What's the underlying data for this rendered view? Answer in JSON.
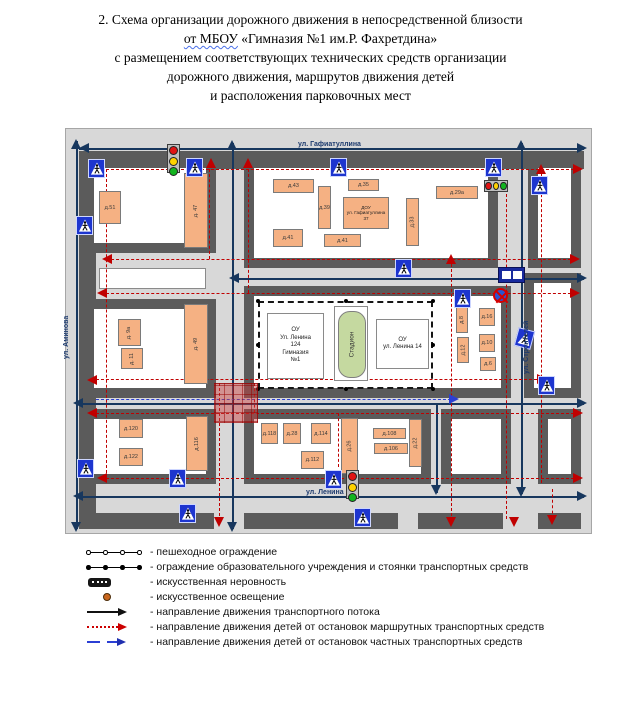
{
  "title": {
    "line1": "2. Схема организации дорожного движения в непосредственной близости",
    "line2_wavy": "от МБОУ",
    "line2_rest": " «Гимназия №1 им.Р. Фахретдина»",
    "line3": "с размещением соответствующих технических средств организации",
    "line4": "дорожного движения, маршрутов движения детей",
    "line5": "и расположения парковочных мест"
  },
  "map": {
    "street_labels": [
      {
        "text": "ул. Гафиатуллина",
        "x": 232,
        "y": 12,
        "rot": 0
      },
      {
        "text": "ул. Аминова",
        "x": -3,
        "y": 230,
        "rot": 1
      },
      {
        "text": "ул. Строителей",
        "x": 457,
        "y": 245,
        "rot": 1
      },
      {
        "text": "ул. Ленина",
        "x": 240,
        "y": 360,
        "rot": 0
      }
    ],
    "bands": [
      [
        13,
        22,
        505,
        18
      ],
      [
        13,
        22,
        17,
        378
      ],
      [
        20,
        384,
        128,
        16
      ],
      [
        178,
        384,
        154,
        16
      ],
      [
        352,
        384,
        85,
        16
      ],
      [
        472,
        384,
        43,
        16
      ]
    ],
    "blocks": [
      [
        18,
        29,
        132,
        95
      ],
      [
        178,
        29,
        254,
        110
      ],
      [
        462,
        29,
        53,
        110
      ],
      [
        18,
        170,
        132,
        99
      ],
      [
        178,
        157,
        267,
        112
      ],
      [
        458,
        144,
        57,
        125
      ],
      [
        18,
        280,
        132,
        75
      ],
      [
        178,
        280,
        187,
        75
      ],
      [
        375,
        280,
        70,
        75
      ],
      [
        472,
        280,
        43,
        75
      ]
    ],
    "strip": [
      33,
      139,
      107,
      21
    ],
    "navy_lines": [
      [
        13,
        19,
        518,
        19
      ],
      [
        10,
        12,
        10,
        400
      ],
      [
        166,
        14,
        166,
        400
      ],
      [
        455,
        14,
        455,
        365
      ],
      [
        370,
        276,
        370,
        364
      ],
      [
        166,
        149,
        518,
        149
      ],
      [
        10,
        274,
        518,
        274
      ],
      [
        10,
        367,
        518,
        367
      ]
    ],
    "red_lines": [
      [
        30,
        40,
        513,
        40
      ],
      [
        40,
        130,
        510,
        130
      ],
      [
        35,
        164,
        510,
        164
      ],
      [
        25,
        250,
        476,
        250
      ],
      [
        25,
        284,
        513,
        284
      ],
      [
        35,
        349,
        513,
        349
      ],
      [
        40,
        40,
        40,
        349
      ],
      [
        143,
        40,
        143,
        130
      ],
      [
        182,
        40,
        182,
        164
      ],
      [
        153,
        254,
        153,
        392
      ],
      [
        188,
        254,
        188,
        284
      ],
      [
        385,
        130,
        385,
        392
      ],
      [
        440,
        65,
        440,
        390
      ],
      [
        475,
        40,
        475,
        354
      ],
      [
        486,
        360,
        486,
        390
      ],
      [
        272,
        284,
        272,
        338
      ]
    ],
    "blue_lines": [
      [
        30,
        270,
        390,
        270
      ]
    ],
    "arrows": [
      [
        13,
        19,
        "left",
        "n"
      ],
      [
        521,
        19,
        "right",
        "n"
      ],
      [
        10,
        10,
        "up",
        "n"
      ],
      [
        10,
        403,
        "down",
        "n"
      ],
      [
        166,
        11,
        "up",
        "n"
      ],
      [
        166,
        403,
        "down",
        "n"
      ],
      [
        455,
        11,
        "up",
        "n"
      ],
      [
        455,
        368,
        "down",
        "n"
      ],
      [
        370,
        366,
        "down",
        "n"
      ],
      [
        163,
        149,
        "left",
        "n"
      ],
      [
        521,
        149,
        "right",
        "n"
      ],
      [
        7,
        274,
        "left",
        "n"
      ],
      [
        521,
        274,
        "right",
        "n"
      ],
      [
        7,
        367,
        "left",
        "n"
      ],
      [
        521,
        367,
        "right",
        "n"
      ],
      [
        517,
        40,
        "right",
        "r"
      ],
      [
        36,
        130,
        "left",
        "r"
      ],
      [
        514,
        130,
        "right",
        "r"
      ],
      [
        31,
        164,
        "left",
        "r"
      ],
      [
        514,
        164,
        "right",
        "r"
      ],
      [
        21,
        251,
        "left",
        "r"
      ],
      [
        481,
        250,
        "right",
        "r"
      ],
      [
        21,
        284,
        "left",
        "r"
      ],
      [
        517,
        284,
        "right",
        "r"
      ],
      [
        31,
        349,
        "left",
        "r"
      ],
      [
        517,
        349,
        "right",
        "r"
      ],
      [
        145,
        29,
        "up",
        "r"
      ],
      [
        182,
        29,
        "up",
        "r"
      ],
      [
        385,
        125,
        "up",
        "r"
      ],
      [
        475,
        35,
        "up",
        "r"
      ],
      [
        153,
        398,
        "down",
        "r"
      ],
      [
        385,
        398,
        "down",
        "r"
      ],
      [
        448,
        398,
        "down",
        "r"
      ],
      [
        486,
        396,
        "down",
        "r"
      ],
      [
        393,
        270,
        "right",
        "b"
      ]
    ],
    "red_zone": [
      148,
      254,
      42,
      38
    ],
    "school": {
      "fence": [
        192,
        172,
        175,
        88
      ],
      "fence_dots": [
        [
          192,
          172
        ],
        [
          367,
          172
        ],
        [
          192,
          260
        ],
        [
          367,
          260
        ],
        [
          280,
          172
        ],
        [
          280,
          260
        ],
        [
          192,
          216
        ],
        [
          367,
          216
        ]
      ],
      "gym": {
        "x": 201,
        "y": 184,
        "w": 57,
        "h": 66,
        "lines": [
          "ОУ",
          "Ул. Ленина",
          "124",
          "Гимназия",
          "№1"
        ]
      },
      "stadium": {
        "x": 268,
        "y": 177,
        "w": 34,
        "h": 75,
        "label": "Стадион"
      },
      "ou2": {
        "x": 310,
        "y": 190,
        "w": 53,
        "h": 50,
        "lines": [
          "ОУ",
          "ул. Ленина 14"
        ]
      }
    },
    "dou": {
      "x": 277,
      "y": 68,
      "w": 46,
      "h": 32,
      "lines": [
        "ДОУ",
        "ул. Гафиатуллина",
        "37"
      ]
    },
    "buildings": [
      [
        "д.51",
        33,
        62,
        22,
        33,
        0
      ],
      [
        "д. 47",
        118,
        44,
        24,
        75,
        1
      ],
      [
        "д.43",
        207,
        50,
        41,
        14,
        0
      ],
      [
        "д.35",
        282,
        50,
        31,
        12,
        0
      ],
      [
        "д.39",
        252,
        57,
        13,
        43,
        0
      ],
      [
        "д.33",
        340,
        69,
        13,
        48,
        1
      ],
      [
        "д.29а",
        370,
        57,
        42,
        13,
        0
      ],
      [
        "д.41",
        207,
        100,
        30,
        18,
        0
      ],
      [
        "д.41",
        258,
        105,
        37,
        13,
        0
      ],
      [
        "д. 9а",
        52,
        190,
        23,
        27,
        1
      ],
      [
        "д. 11",
        55,
        219,
        22,
        21,
        1
      ],
      [
        "д. 49",
        118,
        175,
        24,
        80,
        1
      ],
      [
        "д.8",
        390,
        177,
        12,
        27,
        1
      ],
      [
        "д.16",
        413,
        179,
        16,
        18,
        0
      ],
      [
        "д.10",
        413,
        205,
        16,
        18,
        0
      ],
      [
        "д.12",
        391,
        208,
        12,
        26,
        1
      ],
      [
        "д.6",
        414,
        228,
        16,
        14,
        0
      ],
      [
        "д.120",
        53,
        290,
        24,
        19,
        0
      ],
      [
        "д.122",
        53,
        319,
        24,
        18,
        0
      ],
      [
        "д.116",
        120,
        287,
        22,
        55,
        1
      ],
      [
        "д.118",
        195,
        294,
        17,
        21,
        0
      ],
      [
        "д.28",
        217,
        294,
        18,
        21,
        0
      ],
      [
        "д.114",
        245,
        294,
        20,
        21,
        0
      ],
      [
        "д.26",
        275,
        289,
        17,
        56,
        1
      ],
      [
        "д.112",
        235,
        322,
        23,
        18,
        0
      ],
      [
        "д.108",
        307,
        299,
        33,
        11,
        0
      ],
      [
        "д.106",
        308,
        314,
        34,
        11,
        0
      ],
      [
        "д.22",
        343,
        290,
        13,
        48,
        1
      ]
    ],
    "signs": [
      {
        "t": "ped",
        "x": 22,
        "y": 30
      },
      {
        "t": "ped",
        "x": 10,
        "y": 87
      },
      {
        "t": "ped",
        "x": 120,
        "y": 29
      },
      {
        "t": "ped",
        "x": 264,
        "y": 29
      },
      {
        "t": "ped",
        "x": 419,
        "y": 29
      },
      {
        "t": "ped",
        "x": 465,
        "y": 47
      },
      {
        "t": "ped",
        "x": 329,
        "y": 130
      },
      {
        "t": "ped",
        "x": 388,
        "y": 160
      },
      {
        "t": "ped",
        "x": 450,
        "y": 200,
        "r": 15
      },
      {
        "t": "ped",
        "x": 472,
        "y": 247
      },
      {
        "t": "ped",
        "x": 11,
        "y": 330
      },
      {
        "t": "ped",
        "x": 103,
        "y": 340
      },
      {
        "t": "ped",
        "x": 113,
        "y": 375
      },
      {
        "t": "ped",
        "x": 259,
        "y": 341
      },
      {
        "t": "ped",
        "x": 288,
        "y": 379
      },
      {
        "t": "tlv",
        "x": 101,
        "y": 15
      },
      {
        "t": "tlv",
        "x": 280,
        "y": 341
      },
      {
        "t": "tlh",
        "x": 418,
        "y": 51
      },
      {
        "t": "nostop",
        "x": 427,
        "y": 159
      },
      {
        "t": "bus",
        "x": 432,
        "y": 138
      }
    ],
    "colors": {
      "navy": "#17375e",
      "red": "#c00000",
      "blue": "#2b3fd4",
      "street": "#5b5b5b",
      "building": "#f5b183",
      "sign_blue": "#1d35cf",
      "stadium_green": "#c5d9a0"
    }
  },
  "legend": {
    "items": [
      "- пешеходное ограждение",
      "- ограждение образовательного учреждения и стоянки транспортных средств",
      "- искусственная неровность",
      "- искусственное освещение",
      "- направление движения транспортного потока",
      "- направление движения детей от остановок маршрутных транспортных средств",
      "- направление движения детей от остановок частных транспортных средств"
    ]
  }
}
